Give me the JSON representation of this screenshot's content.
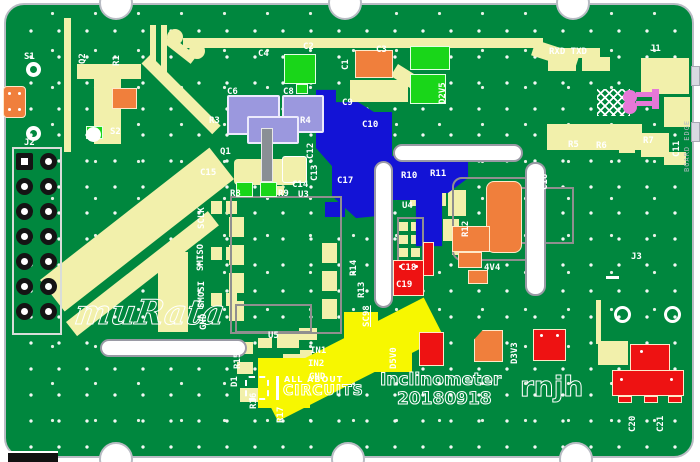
{
  "meta": {
    "type": "pcb-layout-screenshot",
    "board_title": "Inclinometer",
    "date_code": "20180918",
    "author_initials": "rnjh"
  },
  "colors": {
    "board_green": "#00873e",
    "trace_yellow": "#f2f0ab",
    "power_trace_yellow": "#f7f700",
    "plane_blue": "#1313d6",
    "component_red": "#ee1212",
    "component_orange": "#f07f3c",
    "component_green": "#19d619",
    "component_lavender": "#9b98de",
    "silkscreen_white": "#ffffff",
    "board_edge_gray": "#b9bcc4",
    "connector_pink": "#e678d8"
  },
  "texts": {
    "murata_logo": "muRata",
    "aac_line1": "ALL ABOUT",
    "aac_line2": "CIRCUITS",
    "project": "Inclinometer",
    "date": "20180918",
    "initials": "rnjh",
    "board_edge": "BOARD EDGE"
  },
  "silkscreen": [
    {
      "t": "S1",
      "x": 24,
      "y": 52
    },
    {
      "t": "Q2",
      "x": 78,
      "y": 64,
      "r": -90
    },
    {
      "t": "R1",
      "x": 112,
      "y": 66,
      "r": -90
    },
    {
      "t": "S2",
      "x": 110,
      "y": 127
    },
    {
      "t": "J2",
      "x": 24,
      "y": 138
    },
    {
      "t": "C2",
      "x": 303,
      "y": 42
    },
    {
      "t": "C4",
      "x": 258,
      "y": 49
    },
    {
      "t": "C1",
      "x": 341,
      "y": 70,
      "r": -90
    },
    {
      "t": "C3",
      "x": 376,
      "y": 45
    },
    {
      "t": "C9",
      "x": 342,
      "y": 98
    },
    {
      "t": "D2V5",
      "x": 438,
      "y": 104,
      "r": -90
    },
    {
      "t": "C10",
      "x": 362,
      "y": 120
    },
    {
      "t": "RXD TXD",
      "x": 549,
      "y": 47
    },
    {
      "t": "J1",
      "x": 650,
      "y": 44
    },
    {
      "t": "R5",
      "x": 568,
      "y": 140
    },
    {
      "t": "R6",
      "x": 596,
      "y": 141
    },
    {
      "t": "R7",
      "x": 643,
      "y": 136
    },
    {
      "t": "C11",
      "x": 672,
      "y": 157,
      "r": -90
    },
    {
      "t": "C6",
      "x": 227,
      "y": 87
    },
    {
      "t": "C8",
      "x": 283,
      "y": 87
    },
    {
      "t": "R3",
      "x": 209,
      "y": 116
    },
    {
      "t": "R4",
      "x": 300,
      "y": 116
    },
    {
      "t": "Q1",
      "x": 220,
      "y": 147
    },
    {
      "t": "C15",
      "x": 200,
      "y": 168
    },
    {
      "t": "C12",
      "x": 306,
      "y": 159,
      "r": -90
    },
    {
      "t": "C13",
      "x": 310,
      "y": 181,
      "r": -90
    },
    {
      "t": "C17",
      "x": 337,
      "y": 176
    },
    {
      "t": "C14",
      "x": 292,
      "y": 180
    },
    {
      "t": "U3",
      "x": 298,
      "y": 190
    },
    {
      "t": "R8",
      "x": 230,
      "y": 189
    },
    {
      "t": "R9",
      "x": 278,
      "y": 189
    },
    {
      "t": "SCLK",
      "x": 197,
      "y": 229,
      "r": -90
    },
    {
      "t": "SMISO",
      "x": 196,
      "y": 271,
      "r": -90
    },
    {
      "t": "SMOSI",
      "x": 197,
      "y": 308,
      "r": -90
    },
    {
      "t": "GND",
      "x": 199,
      "y": 330,
      "r": -90
    },
    {
      "t": "VREF +",
      "x": 404,
      "y": 153
    },
    {
      "t": "R10",
      "x": 401,
      "y": 171
    },
    {
      "t": "R11",
      "x": 430,
      "y": 169
    },
    {
      "t": "R12",
      "x": 461,
      "y": 237,
      "r": -90
    },
    {
      "t": "U4",
      "x": 402,
      "y": 201
    },
    {
      "t": "C16",
      "x": 540,
      "y": 190,
      "r": -90
    },
    {
      "t": "C18",
      "x": 400,
      "y": 263,
      "c": "on-red"
    },
    {
      "t": "C19",
      "x": 396,
      "y": 280,
      "c": "on-red"
    },
    {
      "t": "4V4",
      "x": 484,
      "y": 263
    },
    {
      "t": "J3",
      "x": 631,
      "y": 252
    },
    {
      "t": "R14",
      "x": 349,
      "y": 276,
      "r": -90
    },
    {
      "t": "R13",
      "x": 357,
      "y": 298,
      "r": -90
    },
    {
      "t": "SC98",
      "x": 362,
      "y": 327,
      "r": -90,
      "u": true
    },
    {
      "t": "D5V0",
      "x": 389,
      "y": 369,
      "r": -90
    },
    {
      "t": "R15",
      "x": 233,
      "y": 369,
      "r": -90
    },
    {
      "t": "D1",
      "x": 230,
      "y": 387,
      "r": -90
    },
    {
      "t": "R16",
      "x": 249,
      "y": 409,
      "r": -90
    },
    {
      "t": "R17",
      "x": 276,
      "y": 423,
      "r": -90
    },
    {
      "t": "U5",
      "x": 268,
      "y": 331
    },
    {
      "t": "IN1",
      "x": 310,
      "y": 346
    },
    {
      "t": "IN2",
      "x": 308,
      "y": 359
    },
    {
      "t": "GND",
      "x": 309,
      "y": 372
    },
    {
      "t": "D3V3",
      "x": 510,
      "y": 364,
      "r": -90
    },
    {
      "t": "C20",
      "x": 628,
      "y": 432,
      "r": -90
    },
    {
      "t": "C21",
      "x": 656,
      "y": 432,
      "r": -90
    }
  ]
}
